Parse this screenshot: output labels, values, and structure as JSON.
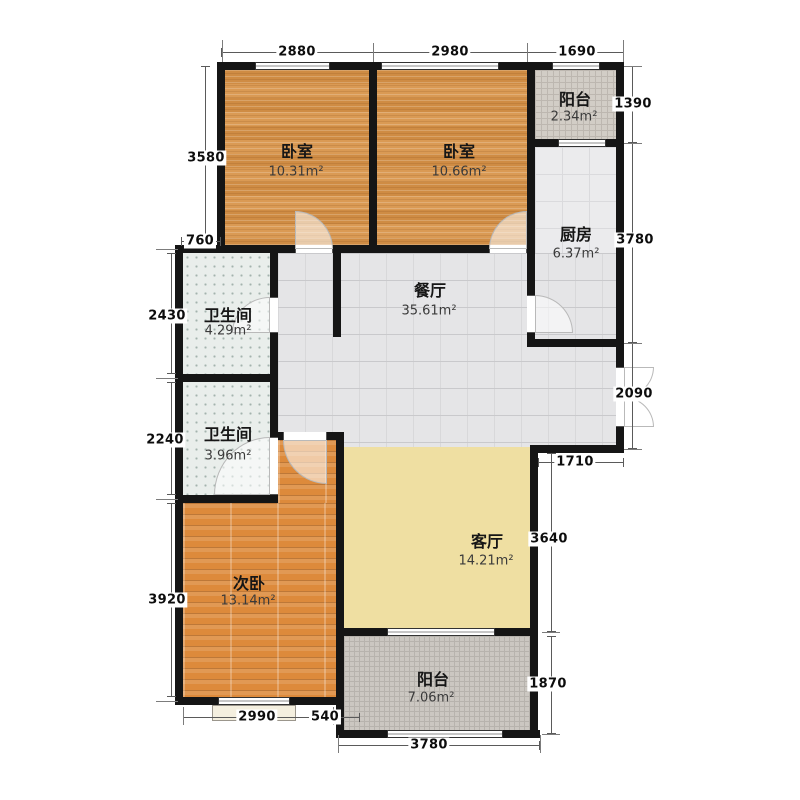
{
  "rooms": [
    {
      "name": "卧室",
      "area": "10.31m²"
    },
    {
      "name": "卧室",
      "area": "10.66m²"
    },
    {
      "name": "阳台",
      "area": "2.34m²"
    },
    {
      "name": "厨房",
      "area": "6.37m²"
    },
    {
      "name": "餐厅",
      "area": "35.61m²"
    },
    {
      "name": "卫生间",
      "area": "4.29m²"
    },
    {
      "name": "卫生间",
      "area": "3.96m²"
    },
    {
      "name": "次卧",
      "area": "13.14m²"
    },
    {
      "name": "客厅",
      "area": "14.21m²"
    },
    {
      "name": "阳台",
      "area": "7.06m²"
    }
  ],
  "dimensions": {
    "top": [
      "2880",
      "2980",
      "1690"
    ],
    "left": [
      "3580",
      "760",
      "2430",
      "2240",
      "3920"
    ],
    "right": [
      "1390",
      "3780",
      "2090",
      "1710",
      "3640",
      "1870"
    ],
    "bottom": [
      "2990",
      "540",
      "3780"
    ]
  },
  "colors": {
    "wall": "#151515",
    "bedroom_floor": "#d79247",
    "second_bedroom_floor": "#dd8a3b",
    "living_floor": "#efdfa2",
    "dining_floor": "#e5e5e7",
    "kitchen_floor": "#ebebed",
    "bathroom_floor": "#e9eeeb",
    "balcony_top_floor": "#d2cdc6",
    "balcony_bottom_floor": "#cbc7c1"
  }
}
